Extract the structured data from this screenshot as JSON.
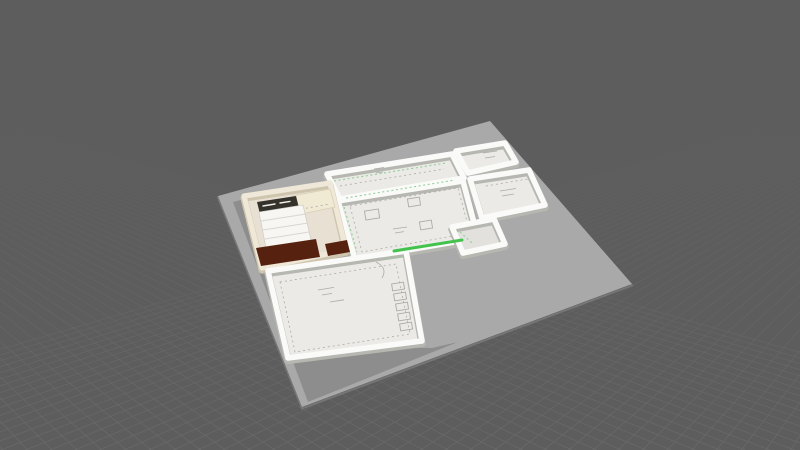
{
  "app": {
    "view_label": "3D perspective view of a single-storey floor plan model placed on a ground platform"
  },
  "viewport": {
    "width": 800,
    "height": 450,
    "colors": {
      "background": "#5d5d5d",
      "grid_line": "#909090",
      "platform": "#a9a9a9",
      "platform_edge": "#767676",
      "wall": "#fafaf8",
      "wall_shadow": "#b7b7b1",
      "floor_paper": "#ebeae6",
      "floor_line": "#adaba5",
      "highlight_green": "#44c24e",
      "accent_green_dash": "#8fcf96",
      "bedroom_floor": "#e7e0d3",
      "bedroom_wall": "#efe8d8",
      "bedroom_wall_shadow": "#cfc5ae",
      "bedroom_counter": "#f0e9d4",
      "bed_linen": "#f7f6f3",
      "bed_pillow": "#35322c",
      "furniture_wood_dark": "#56220f"
    },
    "grid": {
      "spacing": 26,
      "baseline_y": 472,
      "x_start": -420,
      "x_end": 1240,
      "vanishing_point_a": [
        1060,
        40
      ],
      "vanishing_point_b": [
        -380,
        15
      ]
    }
  },
  "scene": {
    "objects": [
      {
        "id": "ground-platform",
        "label": "light gray ground platform"
      },
      {
        "id": "model-shadow",
        "label": "shadow cast by the model"
      },
      {
        "id": "room-top",
        "label": "upper room with plan drawing"
      },
      {
        "id": "room-topright-upper",
        "label": "small upper-right room"
      },
      {
        "id": "room-east",
        "label": "east side room"
      },
      {
        "id": "room-center",
        "label": "central living area with plan drawing"
      },
      {
        "id": "room-protrusion",
        "label": "small square room protruding east"
      },
      {
        "id": "room-bedroom",
        "label": "furnished bedroom"
      },
      {
        "id": "bed",
        "label": "double bed with white linen and dark pillows"
      },
      {
        "id": "counter",
        "label": "cream wardrobe / counter"
      },
      {
        "id": "dresser-wood",
        "label": "dark wood furniture pieces"
      },
      {
        "id": "room-bottom",
        "label": "large lower room with plan drawing"
      },
      {
        "id": "selected-wall-edge",
        "label": "green highlighted wall edge"
      }
    ]
  }
}
